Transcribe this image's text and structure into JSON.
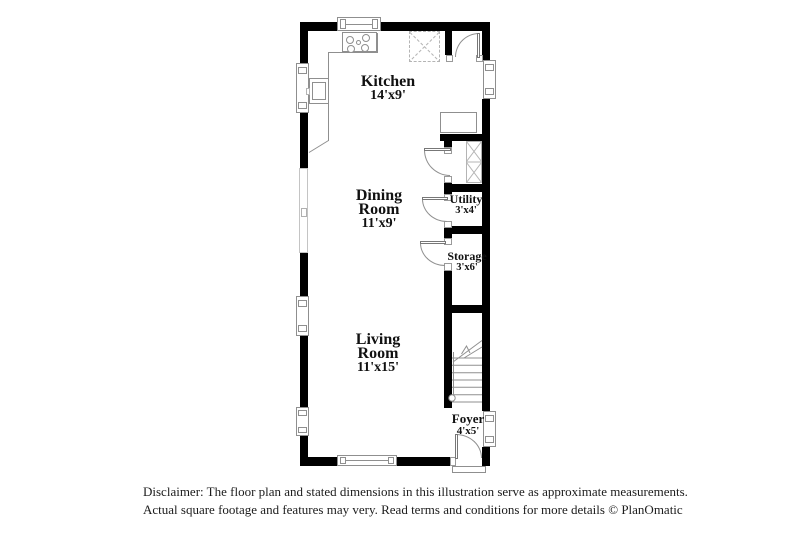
{
  "rooms": {
    "kitchen": {
      "line1": "Kitchen",
      "line2": "14'x9'"
    },
    "dining": {
      "line1": "Dining",
      "line2": "Room",
      "line3": "11'x9'"
    },
    "living": {
      "line1": "Living",
      "line2": "Room",
      "line3": "11'x15'"
    },
    "utility": {
      "line1": "Utility",
      "line2": "3'x4'"
    },
    "storage": {
      "line1": "Storage",
      "line2": "3'x6'"
    },
    "foyer": {
      "line1": "Foyer",
      "line2": "4'x5'"
    }
  },
  "disclaimer": {
    "line1": "Disclaimer: The floor plan and stated dimensions in this illustration serve as approximate measurements.",
    "line2": "Actual square footage and features may very. Read terms and conditions for more details © PlanOmatic"
  },
  "colors": {
    "wall": "#000000",
    "thin_line": "#8f8f8f",
    "light_line": "#b4b4b4",
    "text": "#111111",
    "background": "#ffffff"
  }
}
